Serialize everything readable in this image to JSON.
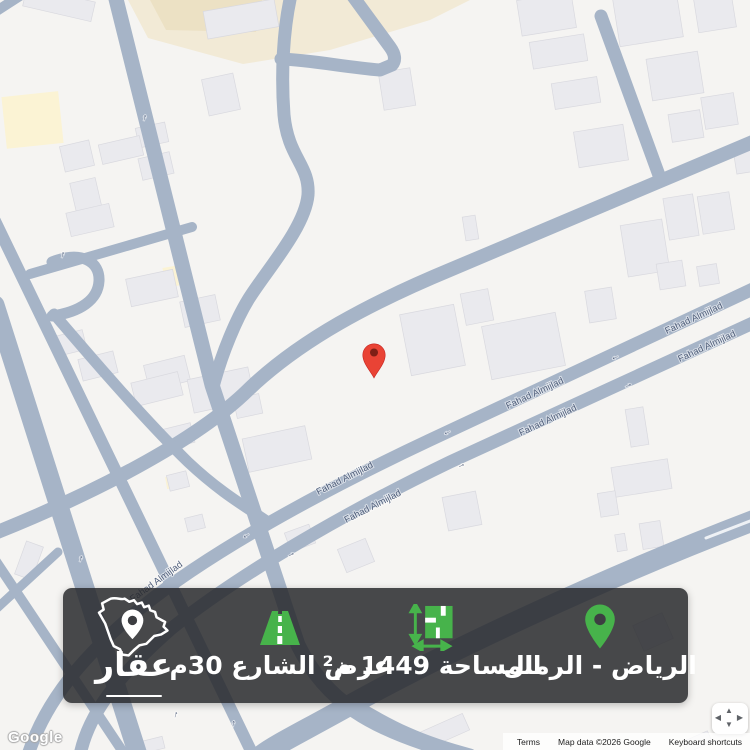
{
  "map": {
    "street_label": "Fahad Almijlad",
    "street_labels_upper": [
      {
        "x": 695,
        "y": 321,
        "r": -25
      },
      {
        "x": 536,
        "y": 396,
        "r": -25
      },
      {
        "x": 346,
        "y": 481,
        "r": -27
      },
      {
        "x": 158,
        "y": 584,
        "r": -36
      }
    ],
    "street_labels_lower": [
      {
        "x": 708,
        "y": 349,
        "r": -25
      },
      {
        "x": 549,
        "y": 423,
        "r": -25
      },
      {
        "x": 374,
        "y": 509,
        "r": -27
      }
    ],
    "street_arrows": [
      {
        "x": 616,
        "y": 359,
        "r": -25,
        "t": "←"
      },
      {
        "x": 448,
        "y": 434,
        "r": -26,
        "t": "←"
      },
      {
        "x": 247,
        "y": 537,
        "r": -31,
        "t": "←"
      },
      {
        "x": 629,
        "y": 387,
        "r": -25,
        "t": "→"
      },
      {
        "x": 462,
        "y": 467,
        "r": -26,
        "t": "→"
      },
      {
        "x": 292,
        "y": 556,
        "r": -28,
        "t": "→"
      },
      {
        "x": 62,
        "y": 257,
        "r": 14,
        "t": "↑"
      },
      {
        "x": 80,
        "y": 561,
        "r": 17,
        "t": "↑"
      },
      {
        "x": 175,
        "y": 717,
        "r": 17,
        "t": "↑"
      },
      {
        "x": 233,
        "y": 726,
        "r": 10,
        "t": "↑"
      },
      {
        "x": 144,
        "y": 120,
        "r": 14,
        "t": "↑"
      }
    ],
    "marker": {
      "x": 374,
      "y": 378,
      "color": "#E94335",
      "center_color": "#7E1F16"
    },
    "colors": {
      "land": "#f5f4f2",
      "road": "#a6b4c7",
      "building": "#eaeaee",
      "building_edge": "#d9d9df",
      "beige": "#f2ead6",
      "beige_dark": "#ece1c4",
      "cream": "#fbf3d4",
      "label": "#51607c"
    }
  },
  "banner": {
    "background": "rgba(40,41,45,0.85)",
    "accent_color": "#47B34B",
    "logo": {
      "label": "عقار",
      "icon": "saudi-map-pin-icon"
    },
    "street_width": {
      "label": "عرض الشارع 30م",
      "icon": "road-icon"
    },
    "area": {
      "label": "المساحة 1449 م²",
      "icon": "dimensions-icon"
    },
    "location": {
      "label": "الرياض - الرمال",
      "icon": "location-pin-icon"
    }
  },
  "attribution": {
    "google_logo": "Google",
    "terms": "Terms",
    "map_data": "Map data ©2026 Google",
    "keyboard_shortcuts": "Keyboard shortcuts"
  },
  "pan_control": {
    "up": "▲",
    "down": "▼",
    "left": "◀",
    "right": "▶"
  }
}
